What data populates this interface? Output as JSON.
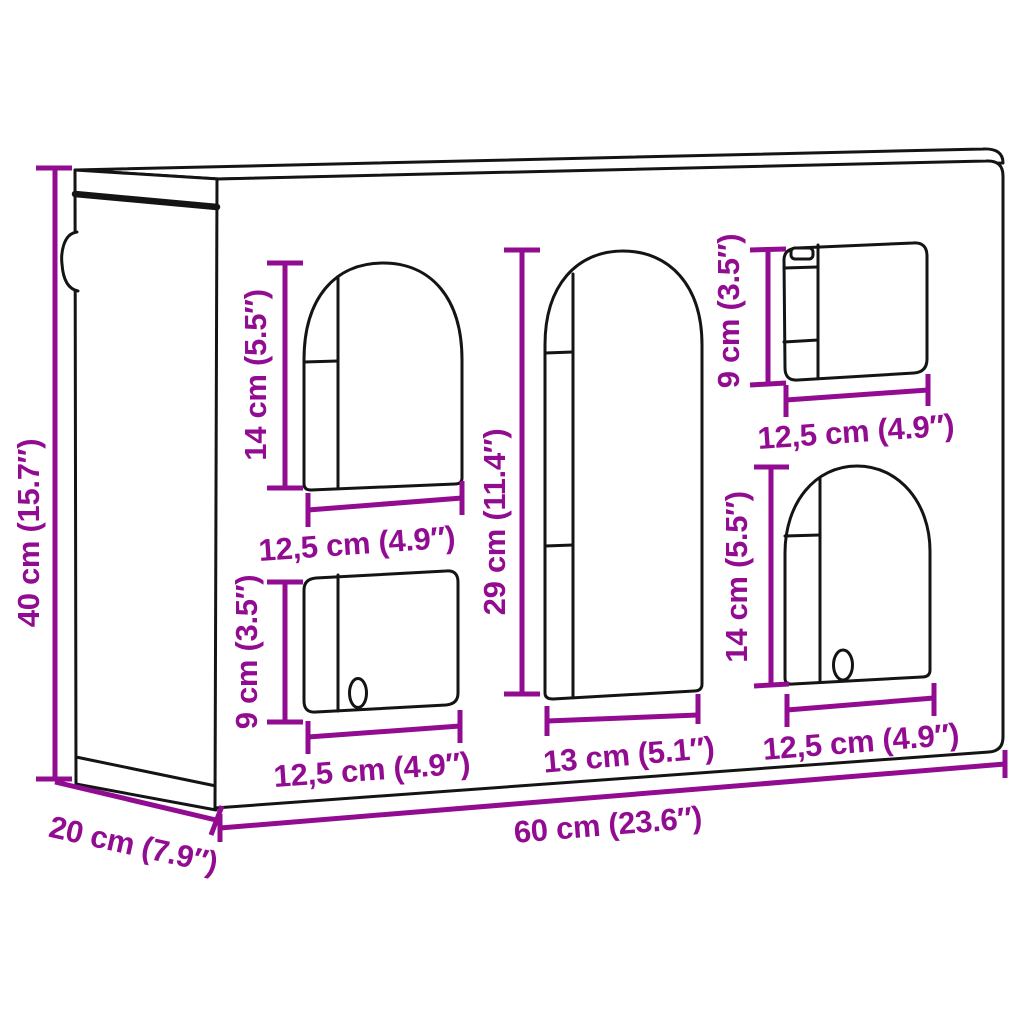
{
  "diagram": {
    "kind": "furniture-dimension-diagram",
    "subject": "wall cabinet with arched and rectangular openings",
    "colors": {
      "dimension_accent": "#920C92",
      "line_work": "#141414",
      "background": "#ffffff"
    },
    "dimensions": {
      "overall_height": "40 cm (15.7″)",
      "overall_depth": "20 cm (7.9″)",
      "overall_width": "60 cm (23.6″)",
      "upper_left_arch": {
        "height": "14 cm (5.5″)",
        "width": "12,5 cm (4.9″)"
      },
      "lower_left_window": {
        "height": "9 cm (3.5″)",
        "width": "12,5 cm (4.9″)"
      },
      "center_arch": {
        "height": "29 cm (11.4″)",
        "width": "13 cm (5.1″)"
      },
      "top_right_window": {
        "height": "9 cm (3.5″)",
        "width": "12,5 cm (4.9″)"
      },
      "lower_right_arch": {
        "height": "14 cm (5.5″)",
        "width": "12,5 cm (4.9″)"
      }
    }
  }
}
